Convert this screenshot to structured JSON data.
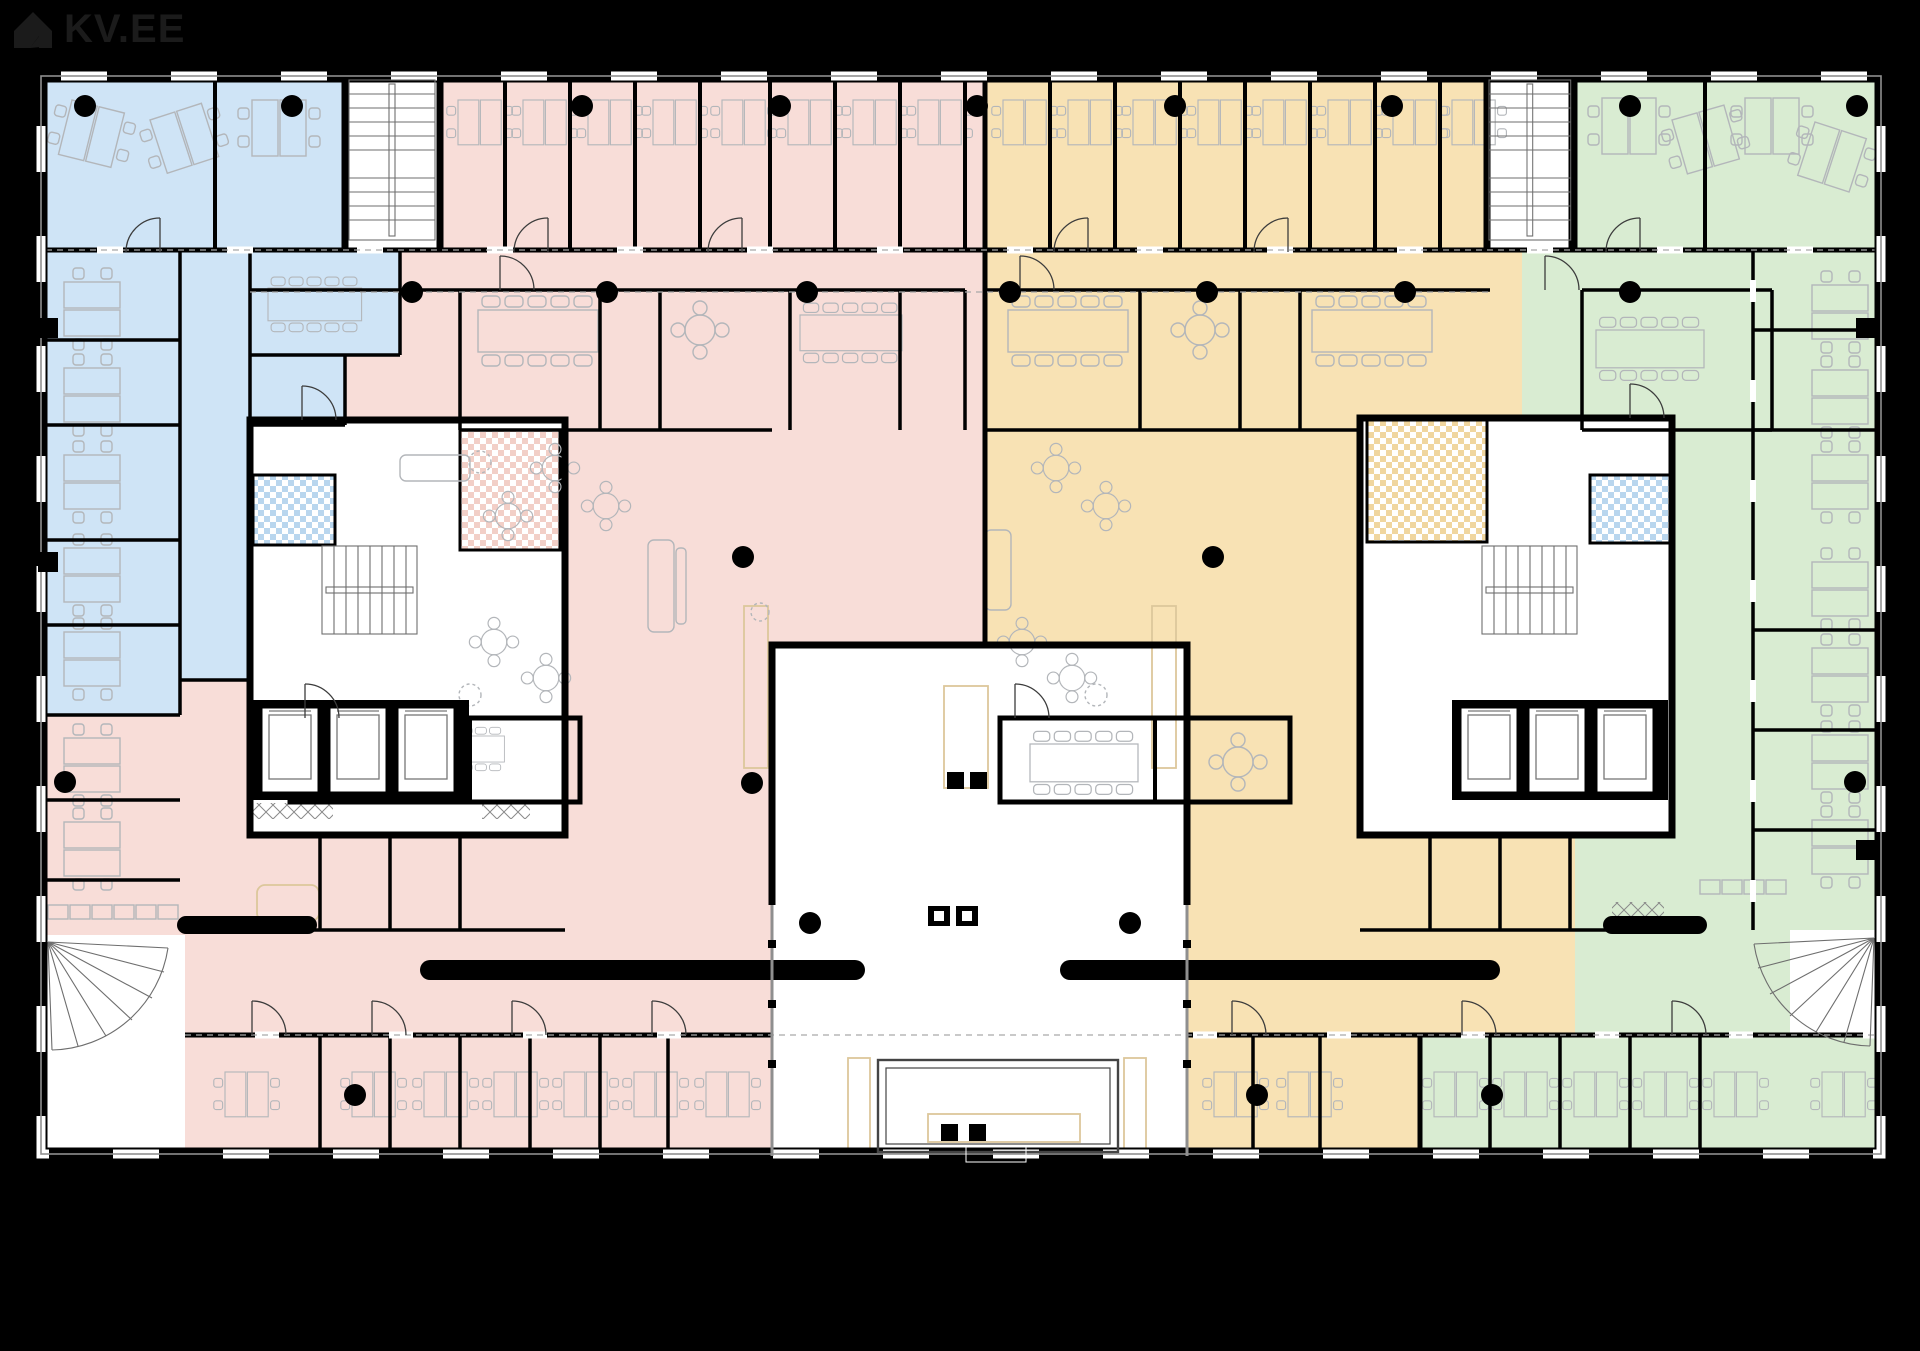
{
  "logo": {
    "text": "KV.EE"
  },
  "plan": {
    "type": "office-building-floor-plan",
    "colors": {
      "bg": "#000000",
      "floor": "#ffffff",
      "wall": "#000000",
      "blue": "#cfe4f6",
      "pink": "#f8ddd8",
      "orange": "#f8e2b4",
      "green": "#d9ecd2",
      "blue-check": "#b9d6ee",
      "pink-check": "#f2cfc7",
      "orange-check": "#f0d69f",
      "line": "#b3b6ba",
      "beige": "#dcc79b",
      "glass": "#8f8f8f",
      "logo": "#1b1b1b"
    },
    "zones": [
      {
        "name": "northwest office zone",
        "color_key": "blue"
      },
      {
        "name": "west office zone",
        "color_key": "pink"
      },
      {
        "name": "east office zone",
        "color_key": "orange"
      },
      {
        "name": "southeast office zone",
        "color_key": "green"
      }
    ],
    "features": {
      "central_atrium": 1,
      "entrance_vestibule": 1,
      "stair_cores": 4,
      "corner_fan_stairs": 2,
      "elevator_cars": 6,
      "wc_blocks": 4,
      "meeting_rooms": 12,
      "column_dots": 28
    }
  }
}
